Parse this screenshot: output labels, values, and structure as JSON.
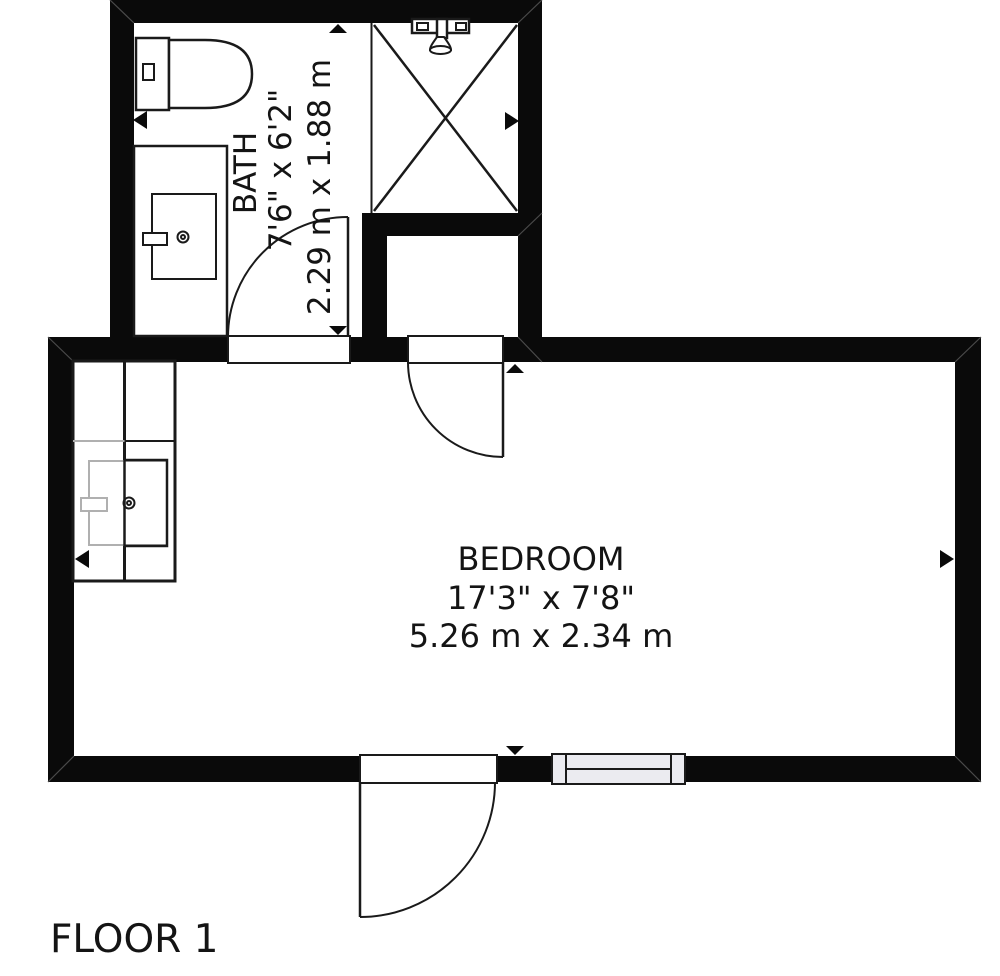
{
  "floor_label": "FLOOR 1",
  "rooms": {
    "bath": {
      "name": "BATH",
      "size_imperial": "7'6\" x 6'2\"",
      "size_metric": "2.29 m x 1.88 m"
    },
    "bedroom": {
      "name": "BEDROOM",
      "size_imperial": "17'3\" x 7'8\"",
      "size_metric": "5.26 m x 2.34 m"
    }
  },
  "fixtures": {
    "toilet": "toilet-icon",
    "shower": "shower-stall-icon",
    "shower_head": "shower-head-icon",
    "bath_sink": "sink-vanity-icon",
    "bedroom_sink": "sink-vanity-icon",
    "window": "window-icon",
    "door_swings": "door-swing-icon",
    "measure_arrows": "measure-arrow-icon"
  },
  "colors": {
    "wall": "#0a0a0a",
    "line": "#1a1a1a",
    "hidden": "#b0b0b0",
    "window": "#ebebf0",
    "bg": "#ffffff",
    "text": "#141414"
  }
}
